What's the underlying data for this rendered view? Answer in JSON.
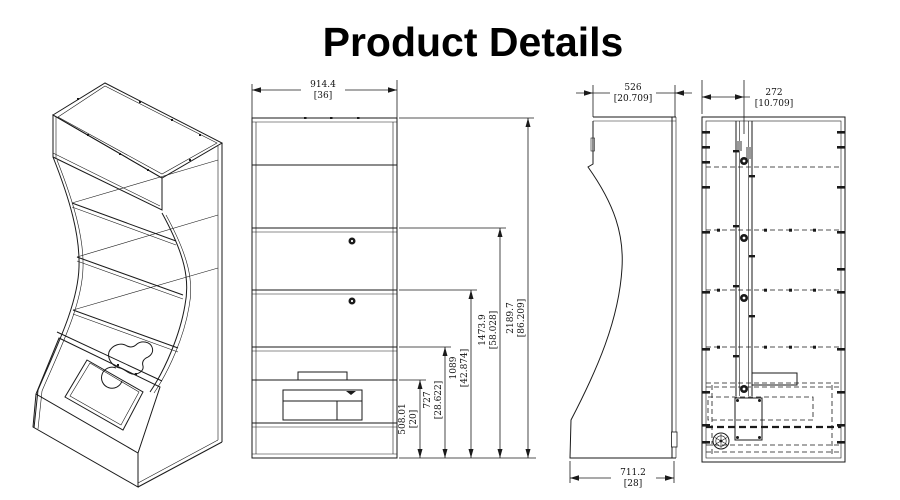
{
  "title": "Product Details",
  "colors": {
    "ink": "#1a1a1a",
    "background": "#ffffff"
  },
  "views": {
    "front": {
      "width_dim": {
        "mm": "914.4",
        "in": "[36]"
      },
      "height_dims": [
        {
          "mm": "508.01",
          "in": "[20]"
        },
        {
          "mm": "727",
          "in": "[28.622]"
        },
        {
          "mm": "1089",
          "in": "[42.874]"
        },
        {
          "mm": "1473.9",
          "in": "[58.028]"
        },
        {
          "mm": "2189.7",
          "in": "[86.209]"
        }
      ]
    },
    "side": {
      "top_dim": {
        "mm": "526",
        "in": "[20.709]"
      },
      "bottom_dim": {
        "mm": "711.2",
        "in": "[28]"
      }
    },
    "section": {
      "top_dim": {
        "mm": "272",
        "in": "[10.709]"
      }
    }
  }
}
